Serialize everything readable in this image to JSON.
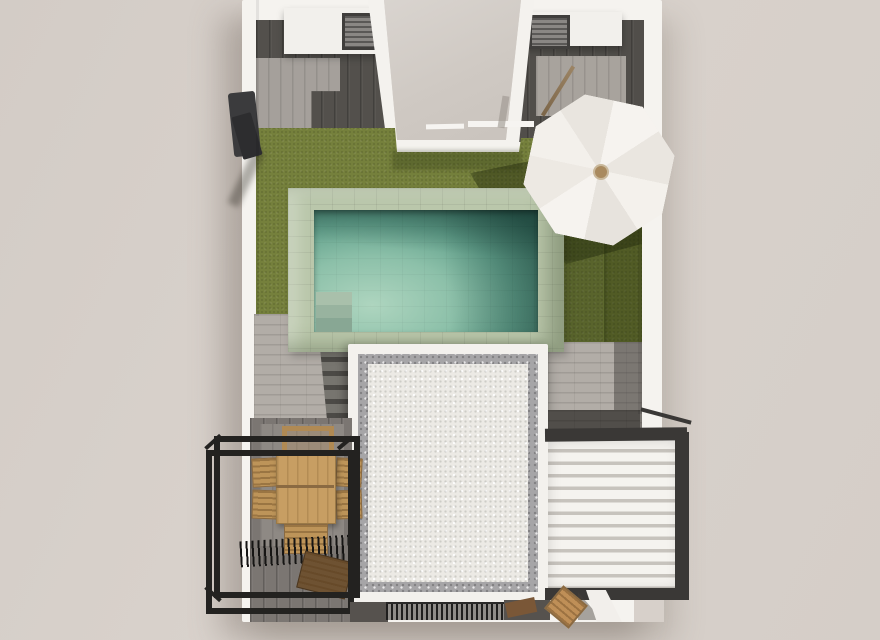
{
  "scene": {
    "type": "3d-architectural-render",
    "view": "top-down-aerial",
    "subject": "villa roof terrace with garden, swimming pool, parasol, dining set and louvered pergola",
    "features": [
      "white-perimeter-walls",
      "dark-tiled-side-terraces",
      "two-ac-units-on-white-plinths",
      "central-stair-void",
      "olive-green-lawn",
      "stone-edged-swimming-pool",
      "pool-corner-steps",
      "tilted-white-parasol",
      "white-gravel-flat-roof-with-grey-border",
      "garden-steps",
      "black-steel-pergola-frame",
      "wooden-dining-table-six-chairs",
      "dark-wood-deck",
      "black-louvre-shade",
      "wooden-bench",
      "white-louvered-pergola-roof",
      "ventilation-grate",
      "wall-mounted-outdoor-shower",
      "wooden-lounge-chair"
    ],
    "colors": {
      "background": "#d7d0ca",
      "wall_white": "#f5f3ef",
      "tile_dark": "#55524e",
      "tile_light": "#a5a09b",
      "stone_light": "#b2ada7",
      "lawn": "#75803c",
      "lawn_shadow": "#39430f",
      "pool_coping": "#bac7ab",
      "pool_water_light": "#aed5bf",
      "pool_water_dark": "#417767",
      "gravel_white": "#eceae5",
      "gravel_border": "#a6a5a7",
      "deck_wood": "#7b7672",
      "furniture_wood": "#c79e63",
      "bench_wood": "#6e5232",
      "frame_black": "#232220",
      "pergola_frame": "#3a3836",
      "pergola_slat": "#f5f3ef",
      "umbrella_canopy": "#f3f0eb",
      "umbrella_hub": "#a98a5f",
      "ac_unit": "#8a8784",
      "void_floor": "#d6d1cc"
    }
  }
}
